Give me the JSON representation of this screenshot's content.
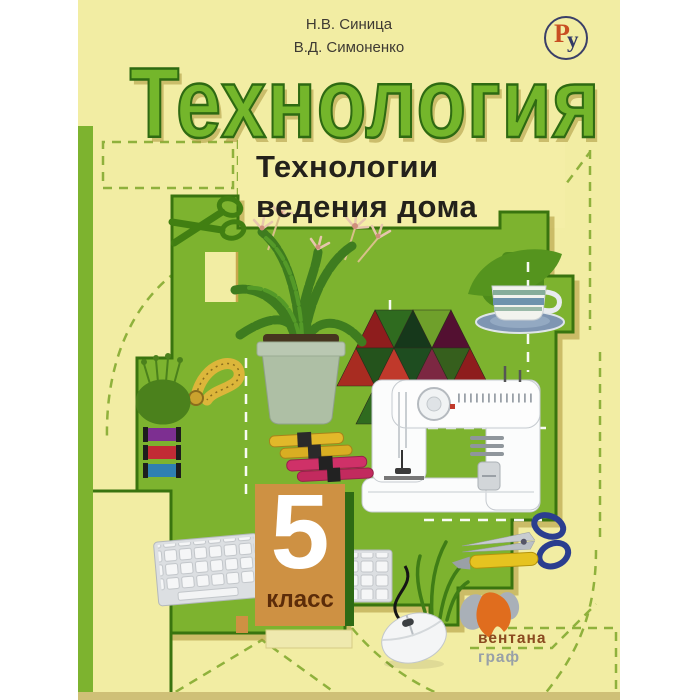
{
  "cover": {
    "authors": {
      "line1": "Н.В. Синица",
      "line2": "В.Д. Симоненко"
    },
    "reader_logo": {
      "letter_p": "Р",
      "letter_u": "у"
    },
    "title": "Технология",
    "subtitle": {
      "line1": "Технологии",
      "line2": "ведения дома"
    },
    "grade": {
      "number": "5",
      "label": "класс"
    },
    "publisher": {
      "line1": "вентана",
      "line2": "граф"
    },
    "colors": {
      "cover_yellow": "#f2eda3",
      "main_green": "#7db32f",
      "dark_green": "#39740f",
      "title_green": "#74b62b",
      "block_orange": "#ce9143",
      "accent_tan": "#c8a84c"
    }
  }
}
